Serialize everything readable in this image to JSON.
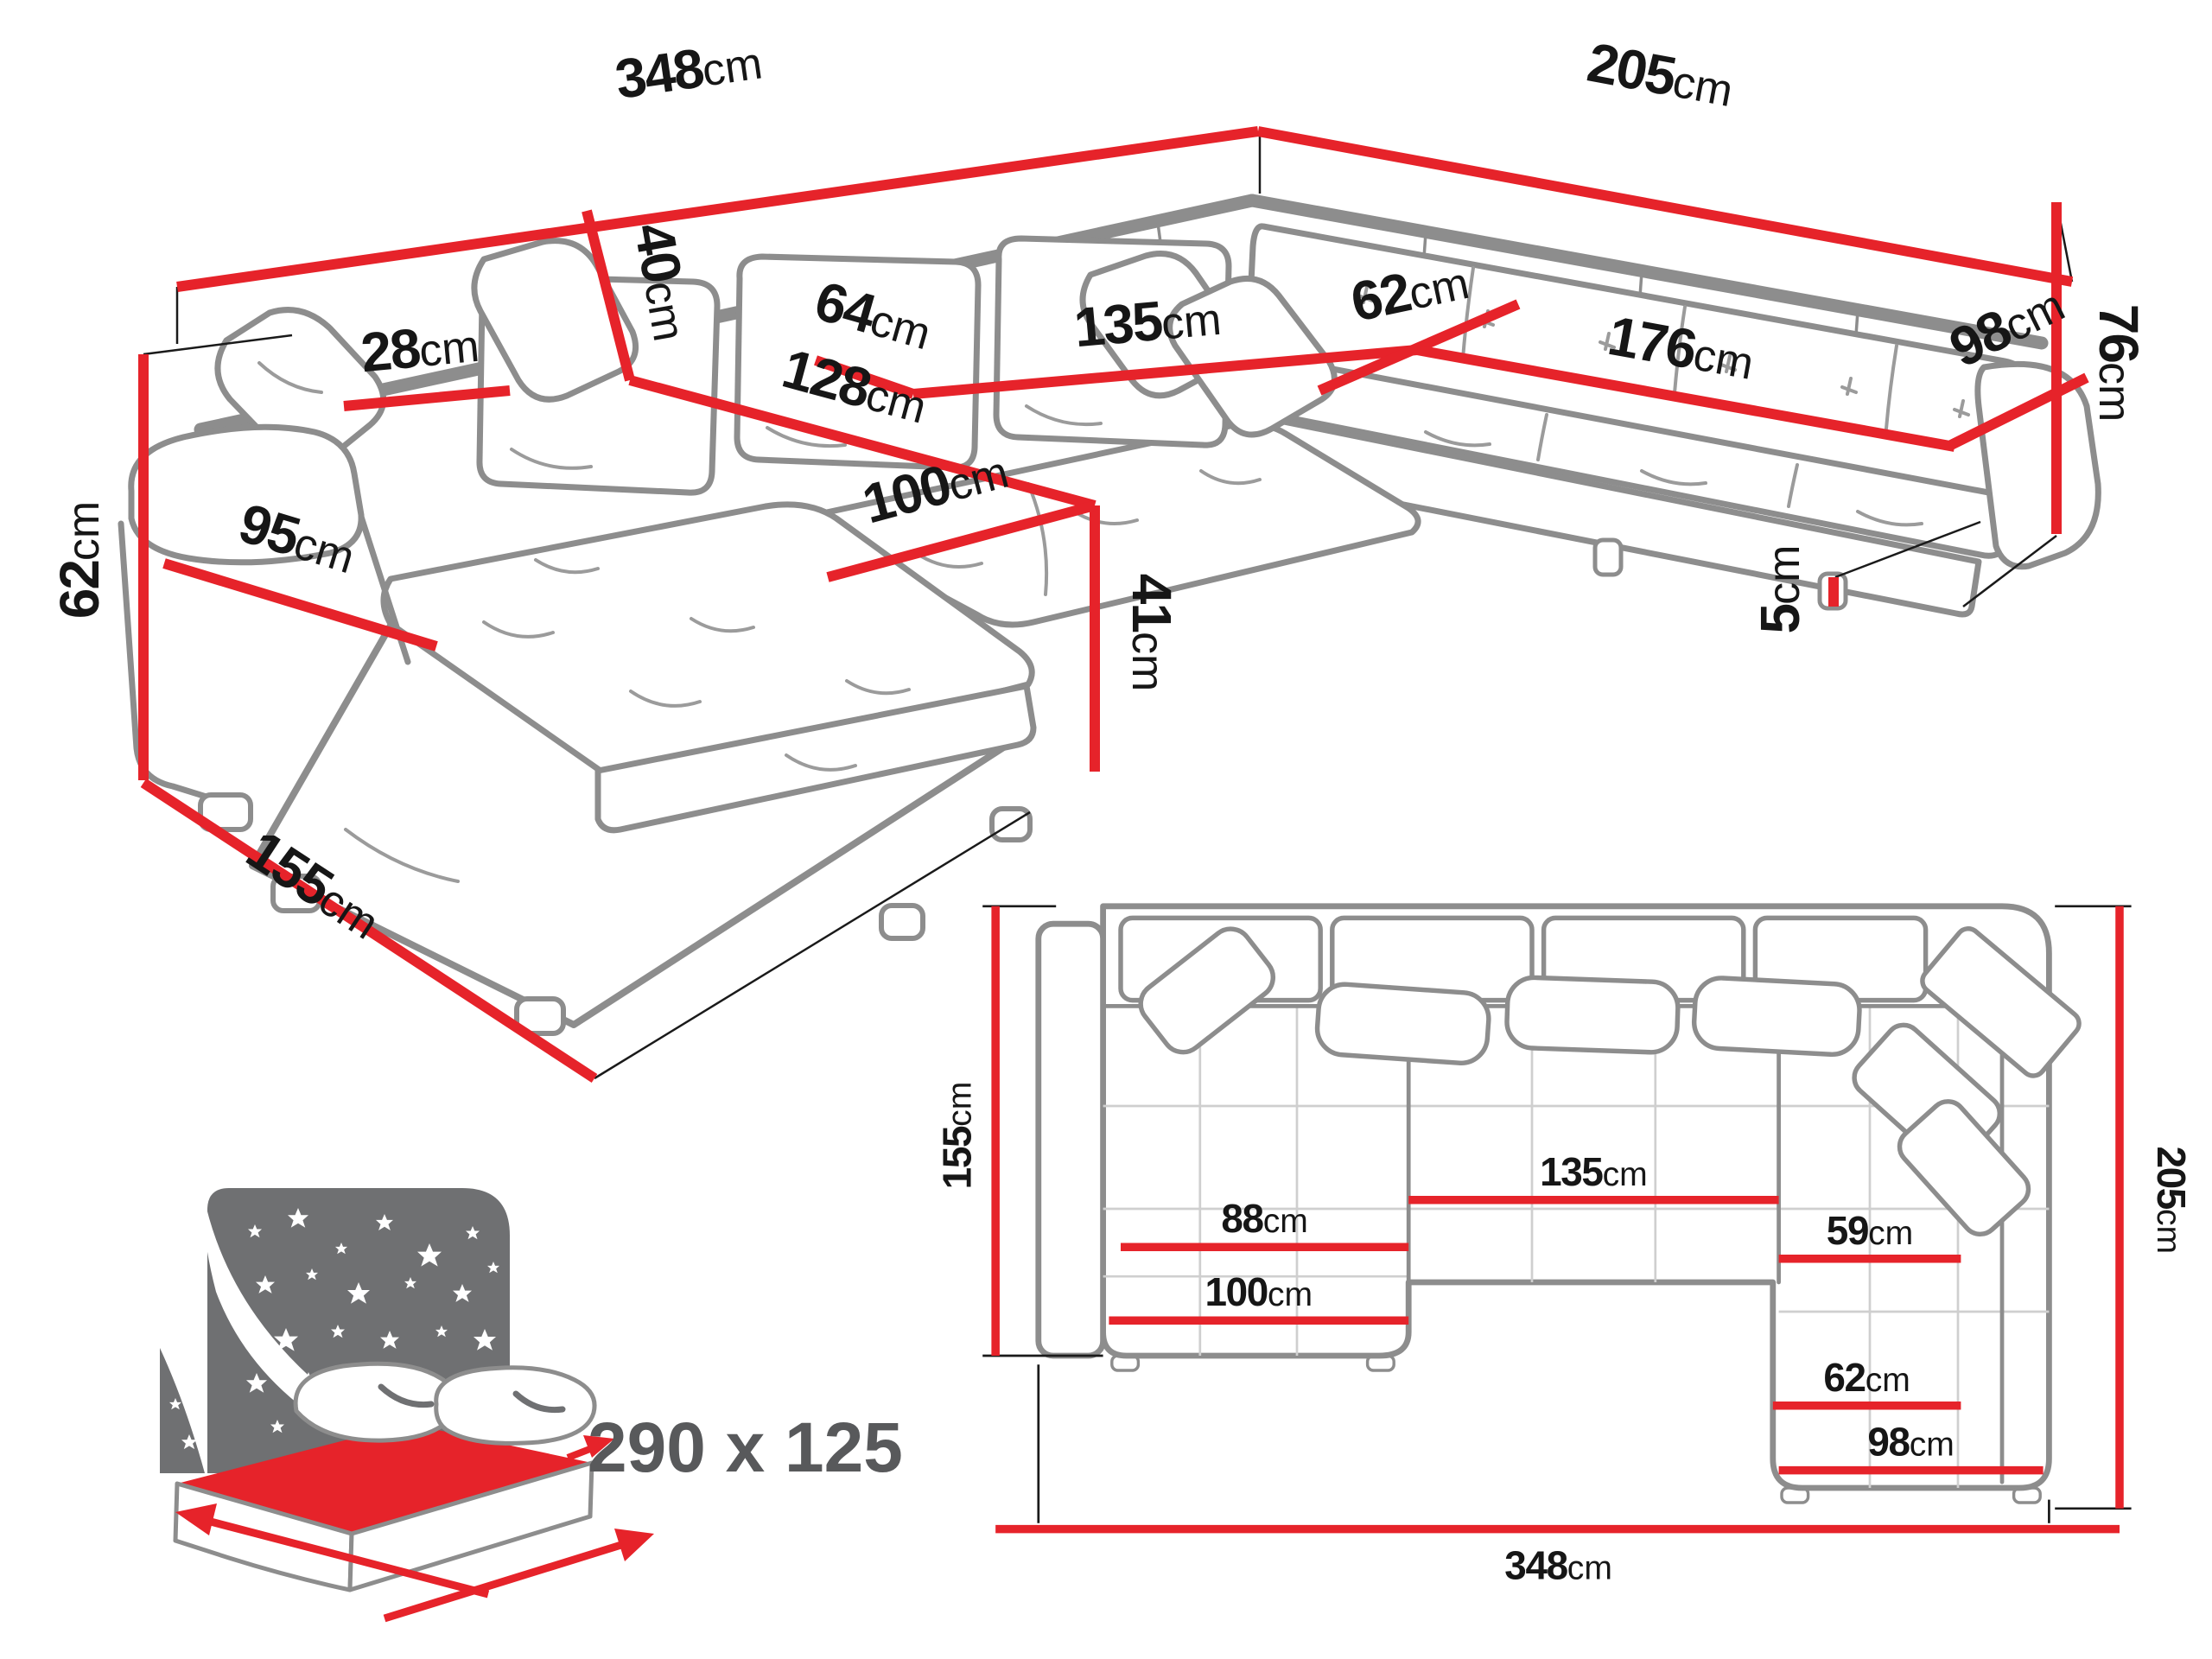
{
  "title": "U-shaped sectional sofa dimension diagram",
  "colors": {
    "dimension_red": "#e6232a",
    "line_art_gray": "#8d8d8d",
    "text_black": "#161616",
    "icon_gray": "#6f7072",
    "sleep_text_gray": "#58595b",
    "background": "#ffffff"
  },
  "persp": {
    "d348": {
      "num": "348",
      "unit": "cm"
    },
    "d205": {
      "num": "205",
      "unit": "cm"
    },
    "d76": {
      "num": "76",
      "unit": "cm"
    },
    "d62_left": {
      "num": "62",
      "unit": "cm"
    },
    "d155": {
      "num": "155",
      "unit": "cm"
    },
    "d95": {
      "num": "95",
      "unit": "cm"
    },
    "d28": {
      "num": "28",
      "unit": "cm"
    },
    "d40": {
      "num": "40",
      "unit": "cm"
    },
    "d64": {
      "num": "64",
      "unit": "cm"
    },
    "d135": {
      "num": "135",
      "unit": "cm"
    },
    "d62_mid": {
      "num": "62",
      "unit": "cm"
    },
    "d176": {
      "num": "176",
      "unit": "cm"
    },
    "d98": {
      "num": "98",
      "unit": "cm"
    },
    "d128": {
      "num": "128",
      "unit": "cm"
    },
    "d100": {
      "num": "100",
      "unit": "cm"
    },
    "d41": {
      "num": "41",
      "unit": "cm"
    },
    "d5": {
      "num": "5",
      "unit": "cm"
    }
  },
  "plan": {
    "d155": {
      "num": "155",
      "unit": "cm"
    },
    "d205": {
      "num": "205",
      "unit": "cm"
    },
    "d348": {
      "num": "348",
      "unit": "cm"
    },
    "d88": {
      "num": "88",
      "unit": "cm"
    },
    "d135": {
      "num": "135",
      "unit": "cm"
    },
    "d59": {
      "num": "59",
      "unit": "cm"
    },
    "d62": {
      "num": "62",
      "unit": "cm"
    },
    "d100": {
      "num": "100",
      "unit": "cm"
    },
    "d98": {
      "num": "98",
      "unit": "cm"
    }
  },
  "sleeping": {
    "dimensions": "290 x 125"
  }
}
